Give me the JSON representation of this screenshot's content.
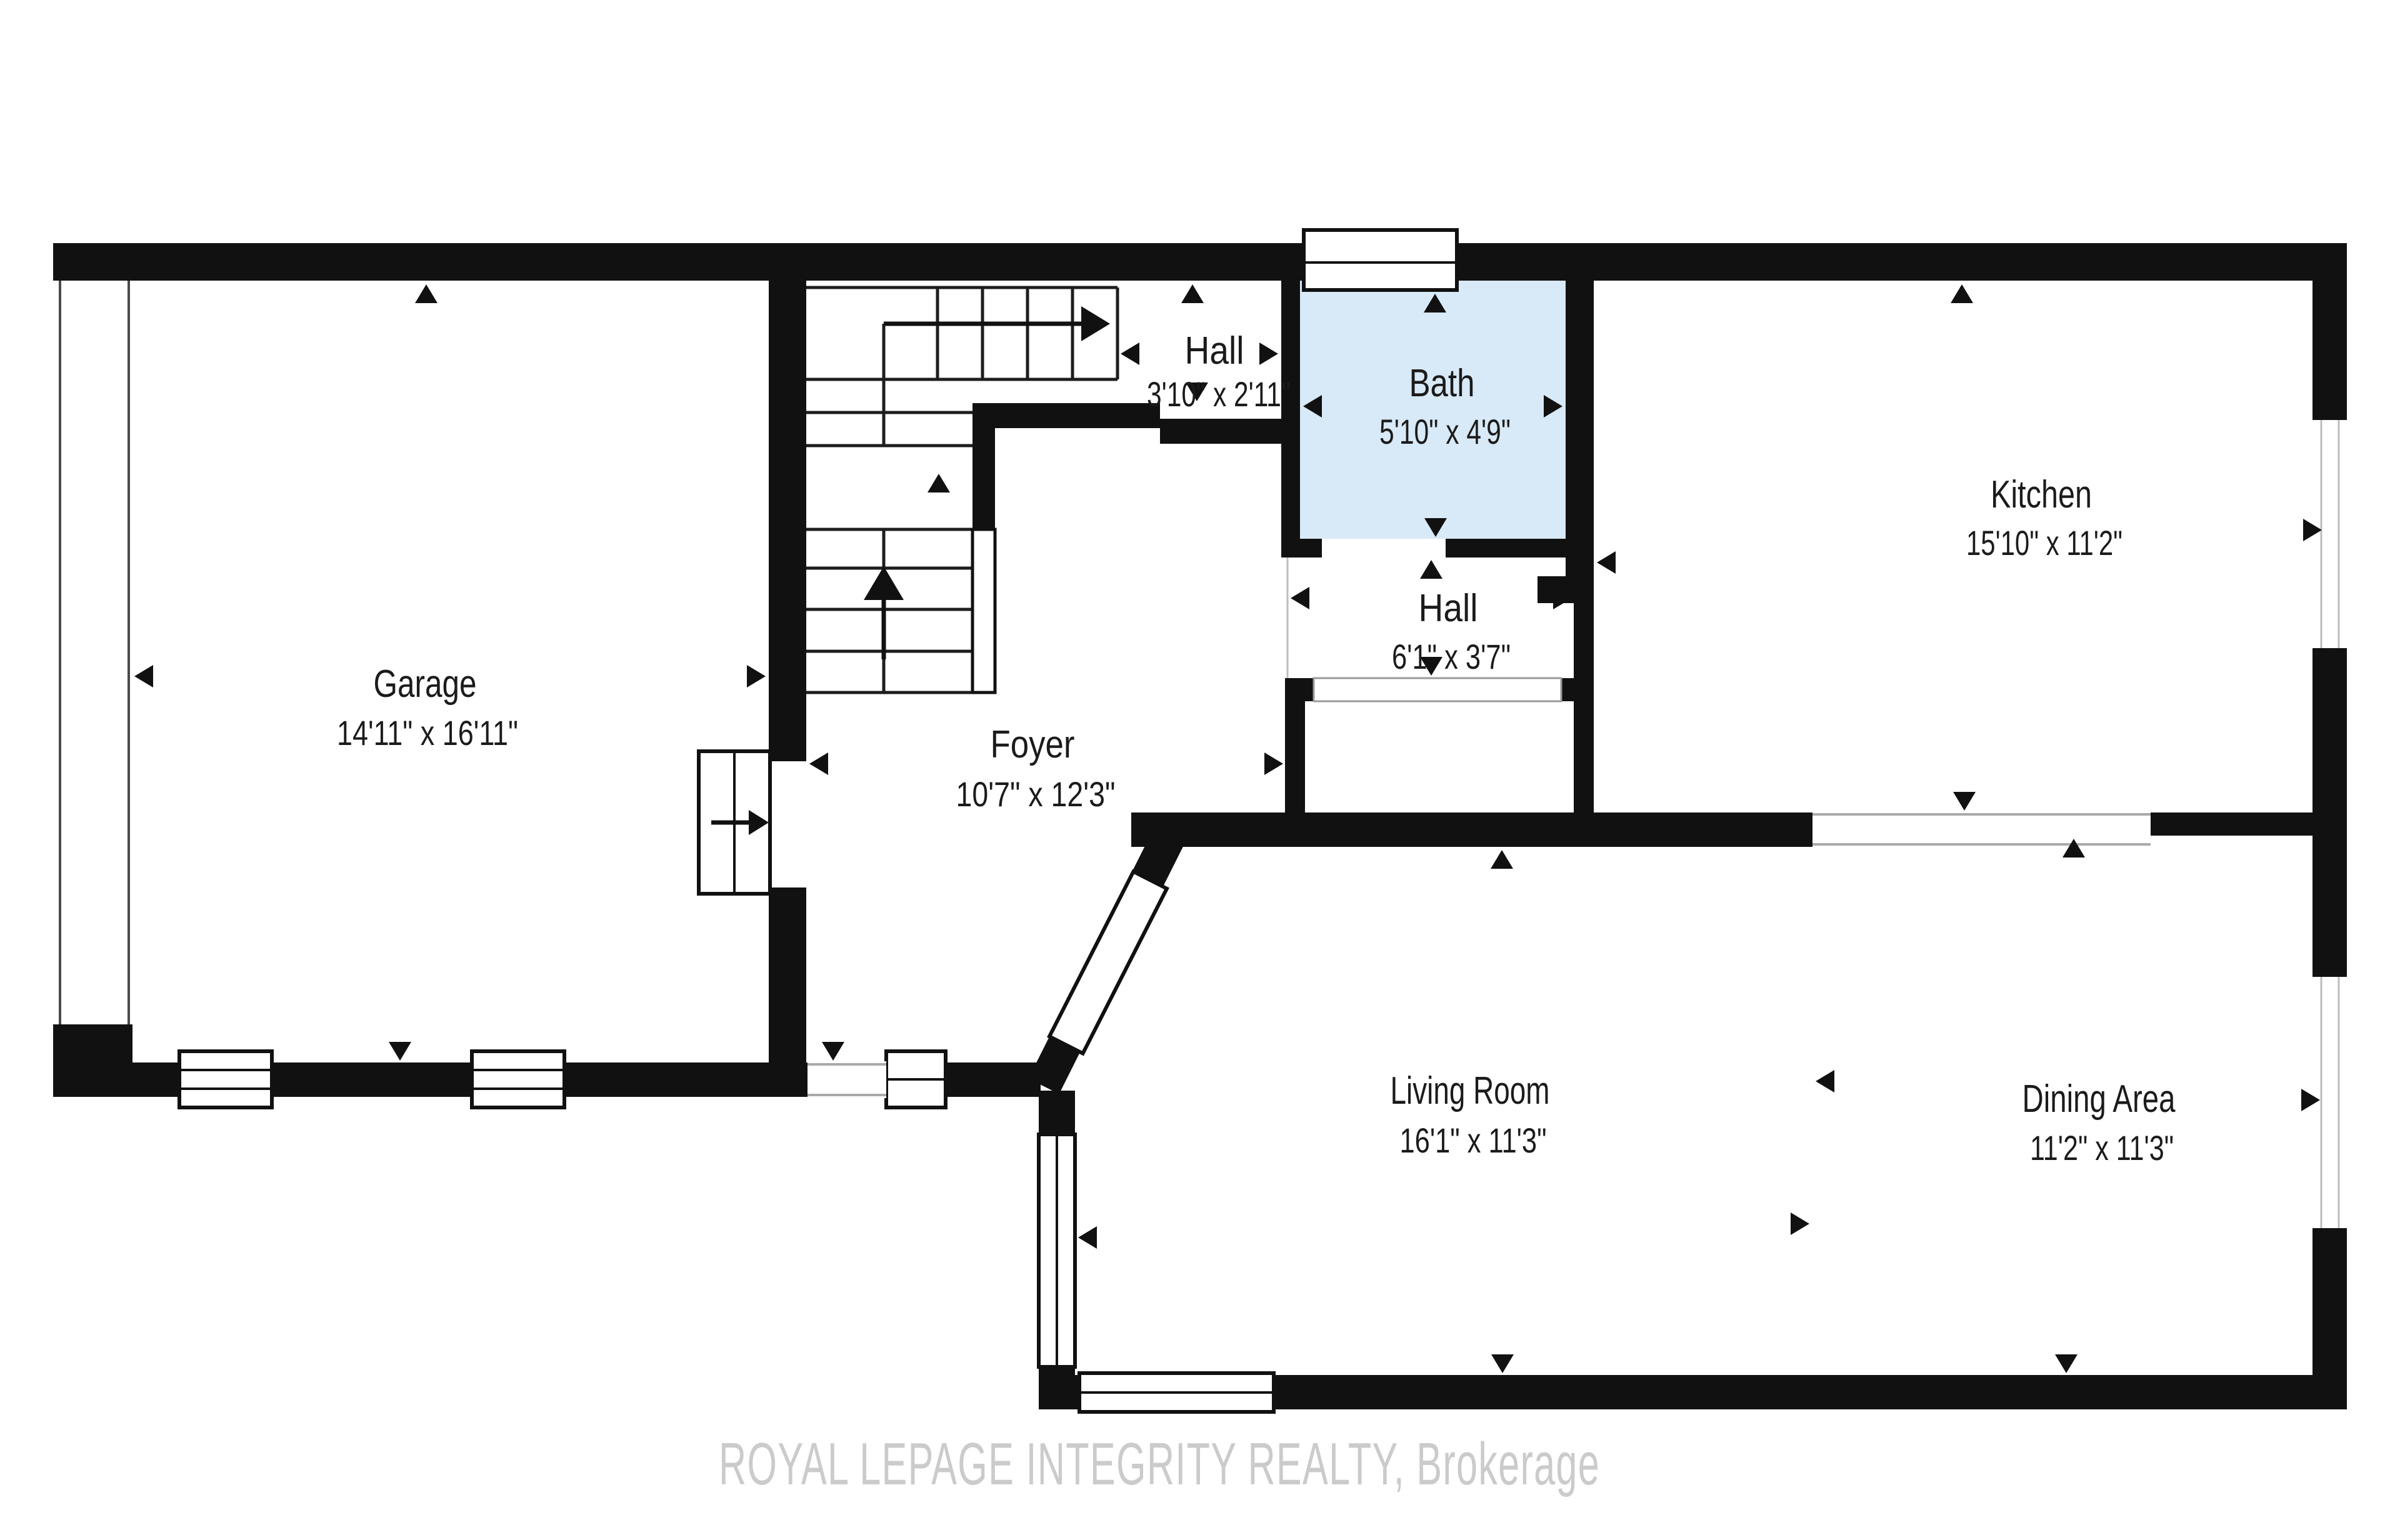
{
  "plan": {
    "type": "floor-plan",
    "watermark": "ROYAL LEPAGE INTEGRITY REALTY, Brokerage"
  },
  "colors": {
    "wall": "#111111",
    "bath_fill": "#d8e9f7",
    "label": "#1b1b1b",
    "watermark": "#cbcbcb",
    "background": "#ffffff"
  },
  "rooms": [
    {
      "id": "garage",
      "name": "Garage",
      "dimensions": "14'11\" x 16'11\""
    },
    {
      "id": "foyer",
      "name": "Foyer",
      "dimensions": "10'7\" x 12'3\""
    },
    {
      "id": "hall-upper",
      "name": "Hall",
      "dimensions": "3'10\" x 2'11\""
    },
    {
      "id": "bath",
      "name": "Bath",
      "dimensions": "5'10\" x 4'9\""
    },
    {
      "id": "hall-lower",
      "name": "Hall",
      "dimensions": "6'1\" x 3'7\""
    },
    {
      "id": "kitchen",
      "name": "Kitchen",
      "dimensions": "15'10\" x 11'2\""
    },
    {
      "id": "living-room",
      "name": "Living Room",
      "dimensions": "16'1\" x 11'3\""
    },
    {
      "id": "dining-area",
      "name": "Dining Area",
      "dimensions": "11'2\" x 11'3\""
    }
  ]
}
